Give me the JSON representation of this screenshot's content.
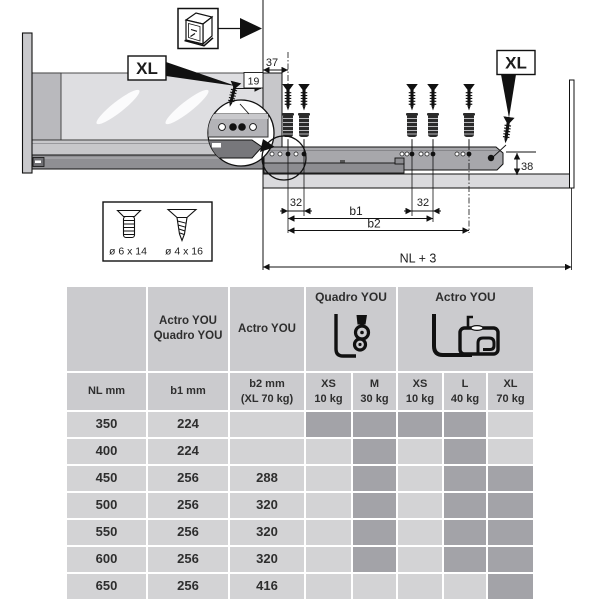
{
  "colors": {
    "header_bg": "#cbcbce",
    "cell_bg": "#d3d3d5",
    "available_bg": "#a3a3a8",
    "diagram_line": "#111111"
  },
  "diagram": {
    "xl_label": "XL",
    "dims": {
      "d37": "37",
      "d19": "19",
      "d32_left": "32",
      "d32_right": "32",
      "b1": "b1",
      "b2": "b2",
      "nl": "NL + 3",
      "d38": "38"
    },
    "screw_legend": {
      "screw_large": "ø 6 x 14",
      "screw_small": "ø 4 x 16"
    }
  },
  "table": {
    "group_b1": {
      "line1": "Actro YOU",
      "line2": "Quadro YOU"
    },
    "group_b2": "Actro YOU",
    "group_quadro": "Quadro YOU",
    "group_actro": "Actro YOU",
    "col_nl": "NL mm",
    "col_b1": "b1 mm",
    "col_b2": {
      "line1": "b2 mm",
      "line2": "(XL 70 kg)"
    },
    "size_cols": [
      {
        "size": "XS",
        "load": "10 kg"
      },
      {
        "size": "M",
        "load": "30 kg"
      },
      {
        "size": "XS",
        "load": "10 kg"
      },
      {
        "size": "L",
        "load": "40 kg"
      },
      {
        "size": "XL",
        "load": "70 kg"
      }
    ],
    "rows": [
      {
        "nl": "350",
        "b1": "224",
        "b2": "",
        "avail": [
          true,
          true,
          true,
          true,
          false
        ]
      },
      {
        "nl": "400",
        "b1": "224",
        "b2": "",
        "avail": [
          false,
          true,
          false,
          true,
          false
        ]
      },
      {
        "nl": "450",
        "b1": "256",
        "b2": "288",
        "avail": [
          false,
          true,
          false,
          true,
          true
        ]
      },
      {
        "nl": "500",
        "b1": "256",
        "b2": "320",
        "avail": [
          false,
          true,
          false,
          true,
          true
        ]
      },
      {
        "nl": "550",
        "b1": "256",
        "b2": "320",
        "avail": [
          false,
          true,
          false,
          true,
          true
        ]
      },
      {
        "nl": "600",
        "b1": "256",
        "b2": "320",
        "avail": [
          false,
          true,
          false,
          true,
          true
        ]
      },
      {
        "nl": "650",
        "b1": "256",
        "b2": "416",
        "avail": [
          false,
          false,
          false,
          false,
          true
        ]
      }
    ]
  }
}
